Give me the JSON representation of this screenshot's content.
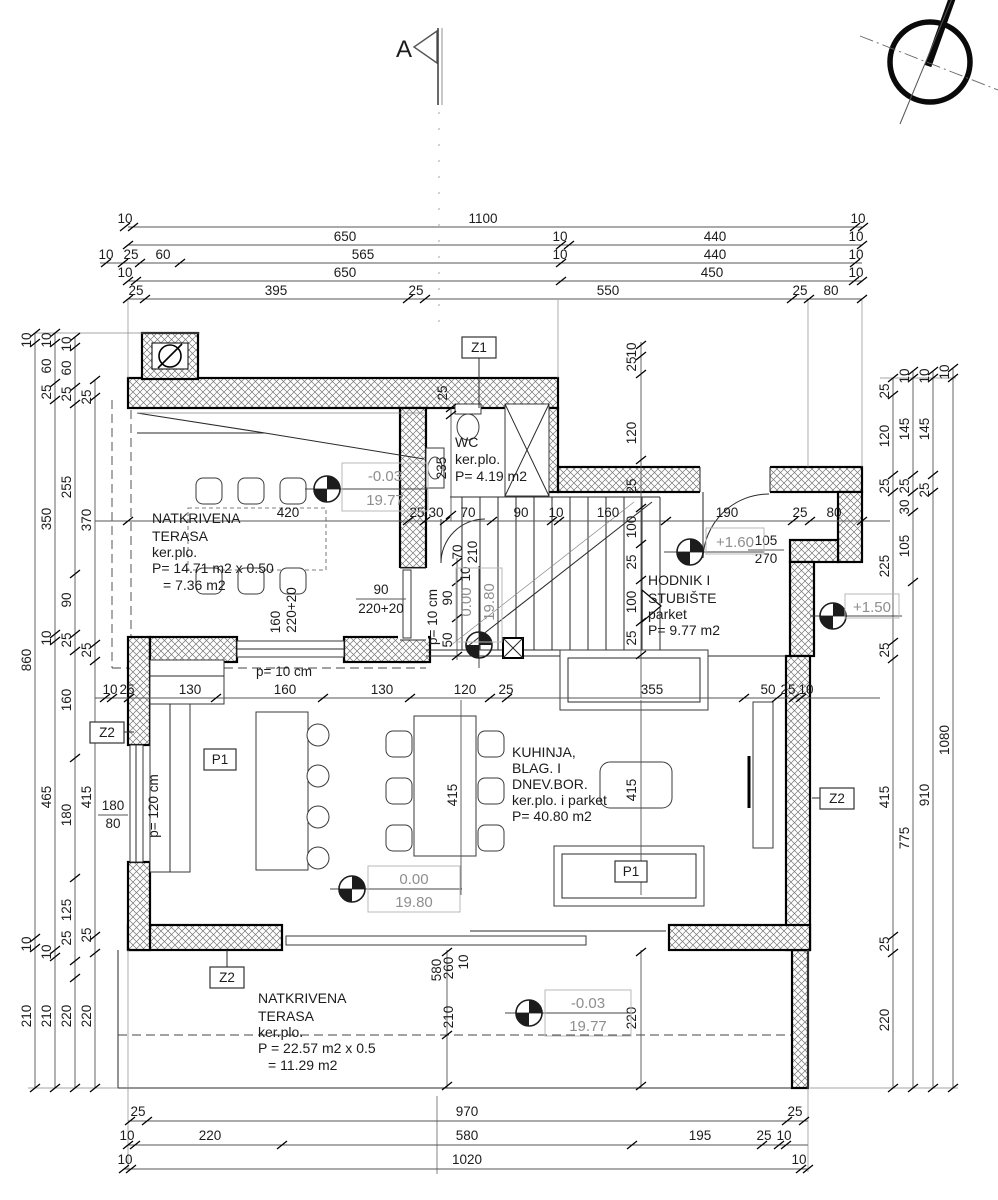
{
  "colors": {
    "ink": "#1c1c1c",
    "muted": "#8e8e8e",
    "wall_hatch": "#777777"
  },
  "tags": {
    "section": "A",
    "z1": "Z1",
    "z2": "Z2",
    "p1": "P1"
  },
  "rooms": {
    "terasa1": [
      "NATKRIVENA",
      "TERASA",
      "ker.plo.",
      "P= 14.71 m2 x 0.50",
      "= 7.36 m2"
    ],
    "wc": [
      "WC",
      "ker.plo.",
      "P= 4.19 m2"
    ],
    "hodnik": [
      "HODNIK I",
      "STUBIŠTE",
      "parket",
      "P= 9.77 m2"
    ],
    "living": [
      "KUHINJA,",
      "BLAG. I",
      "DNEV.BOR.",
      "ker.plo. i parket",
      "P= 40.80 m2"
    ],
    "terasa2": [
      "NATKRIVENA",
      "TERASA",
      "ker.plo.",
      "P = 22.57 m2 x 0.5",
      "= 11.29 m2"
    ]
  },
  "levels": {
    "t1": [
      "-0.03",
      "19.77"
    ],
    "stair": [
      "0.00",
      "19.80"
    ],
    "living": [
      "0.00",
      "19.80"
    ],
    "t2": [
      "-0.03",
      "19.77"
    ],
    "hall": "+1.60",
    "entry": "+1.50"
  },
  "windows": {
    "terr_door": [
      "90",
      "220+20"
    ],
    "terr_win": [
      "160",
      "220+20"
    ],
    "wc_door": [
      "70",
      "210"
    ],
    "entry_door": [
      "105",
      "270"
    ],
    "living_win": [
      "180",
      "80"
    ],
    "p_labels": [
      "p= 10 cm",
      "p= 10 cm",
      "p= 120 cm"
    ]
  },
  "dims": {
    "top_r1": [
      "10",
      "1100",
      "10"
    ],
    "top_r2": [
      "650",
      "10",
      "440",
      "10"
    ],
    "top_r3": [
      "10",
      "25",
      "60",
      "565",
      "10",
      "440",
      "10"
    ],
    "top_r4": [
      "10",
      "650",
      "450",
      "10"
    ],
    "top_r5": [
      "25",
      "395",
      "25",
      "550",
      "25",
      "80"
    ],
    "bot_r1": [
      "25",
      "970",
      "25"
    ],
    "bot_r2": [
      "10",
      "220",
      "580",
      "195",
      "25",
      "10"
    ],
    "bot_r3": [
      "10",
      "1020",
      "10"
    ],
    "left_a": [
      "10",
      "860",
      "10",
      "210"
    ],
    "left_b": [
      "10",
      "60",
      "25",
      "350",
      "10",
      "465",
      "10",
      "210"
    ],
    "left_c": [
      "10",
      "60",
      "25",
      "255",
      "90",
      "25",
      "160",
      "180",
      "125",
      "25",
      "220"
    ],
    "left_d": [
      "25",
      "370",
      "25",
      "415",
      "25",
      "220"
    ],
    "right_a": [
      "25",
      "120",
      "25",
      "225",
      "25",
      "415",
      "25",
      "220"
    ],
    "right_b": [
      "10",
      "145",
      "25",
      "30",
      "105",
      "775"
    ],
    "right_c": [
      "10",
      "145",
      "25",
      "910"
    ],
    "right_d": [
      "10",
      "1080"
    ],
    "row_mid": [
      "420",
      "25",
      "30",
      "70",
      "90",
      "10",
      "160",
      "190",
      "25",
      "80"
    ],
    "row_low": [
      "10",
      "25",
      "130",
      "160",
      "130",
      "120",
      "25",
      "355",
      "50",
      "25",
      "10"
    ],
    "v_entry": [
      "10",
      "25",
      "120",
      "25",
      "100",
      "25",
      "100",
      "25"
    ],
    "v_stair": [
      "10",
      "90",
      "50"
    ],
    "v_wc": [
      "25",
      "235"
    ],
    "v_terr": [
      "580",
      "260",
      "10",
      "210",
      "220"
    ],
    "v_living": [
      "415",
      "415"
    ]
  }
}
